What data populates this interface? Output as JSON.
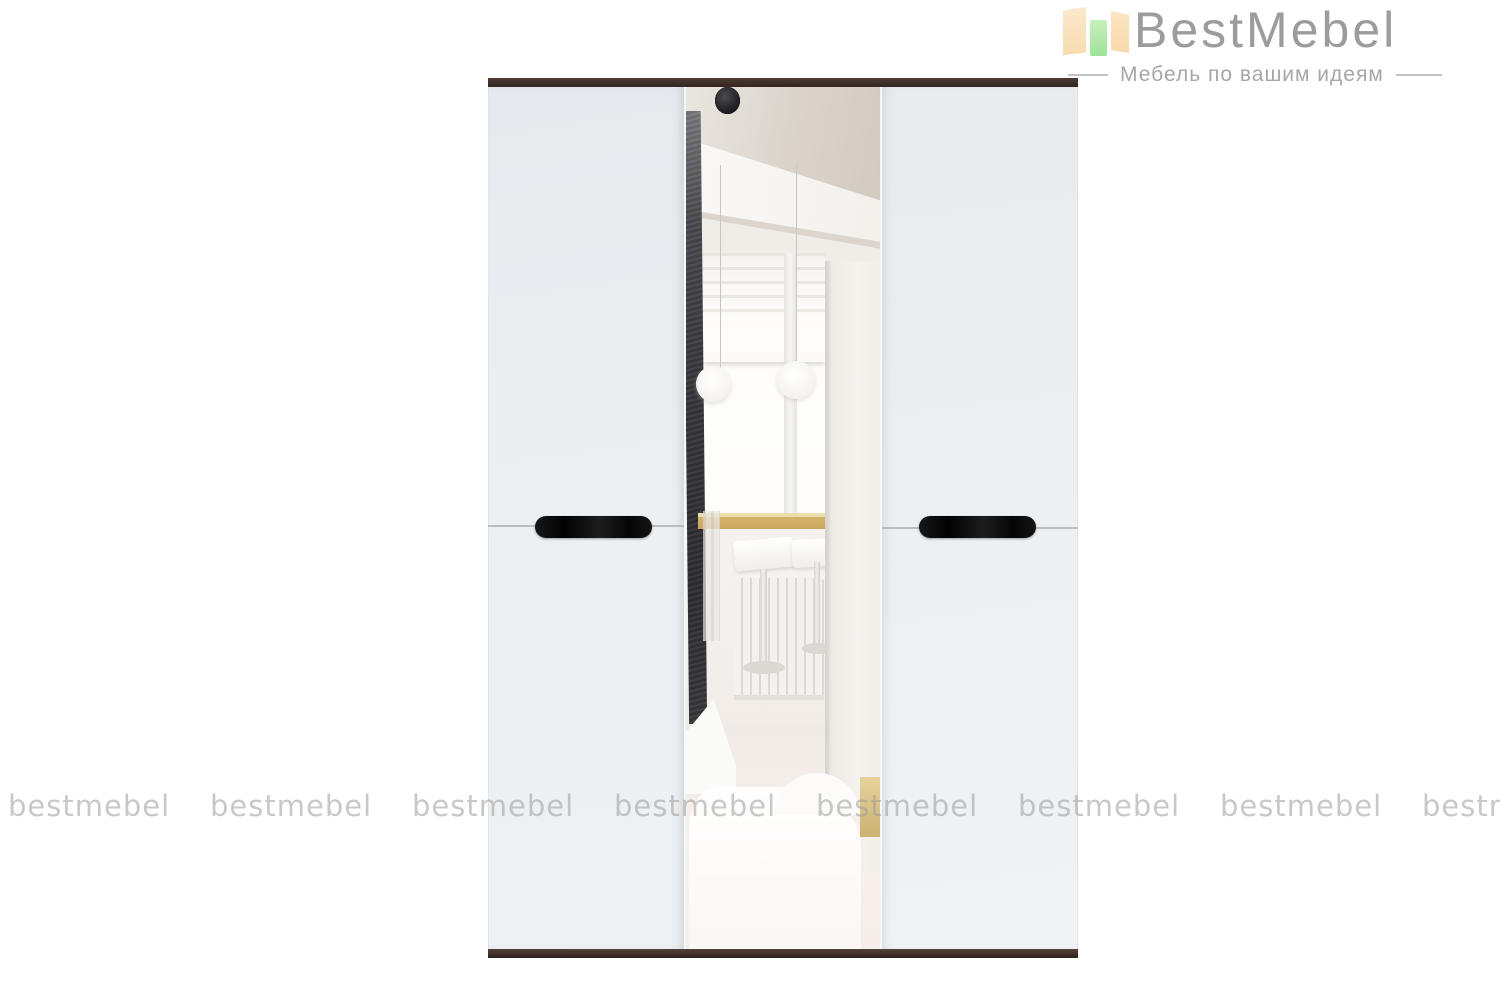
{
  "page": {
    "background": "#ffffff"
  },
  "logo": {
    "brand": "BestMebel",
    "tagline": "Мебель по вашим идеям",
    "icon_name": "bar-chart-logo-icon",
    "colors": {
      "bar_peach": "#f8ddb2",
      "bar_green": "#a5e49f",
      "brand_text": "#9c9c9c",
      "tagline_text": "#a6a6a6"
    }
  },
  "watermark": {
    "text": "bestmebel",
    "color": "#c3c3c3",
    "repeat_count": 8
  },
  "product_image": {
    "description": "Three-door wardrobe with central mirror door: white gloss side doors, dark wenge top and bottom trim, two black horizontal pill handles; mirror reflects a room interior with ceiling beam, window, pendant globe lamps, tan bar counter, bar stools, radiator, dark sphere stand and white sofa",
    "frame_color": "#3a2c27",
    "door_color": "#eaedf0",
    "handle_color": "#0e0e0e",
    "mirror_reflection": {
      "counter_color": "#d2b26a",
      "pillar_color": "#353438",
      "cube_color": "#d5ba7e"
    }
  }
}
